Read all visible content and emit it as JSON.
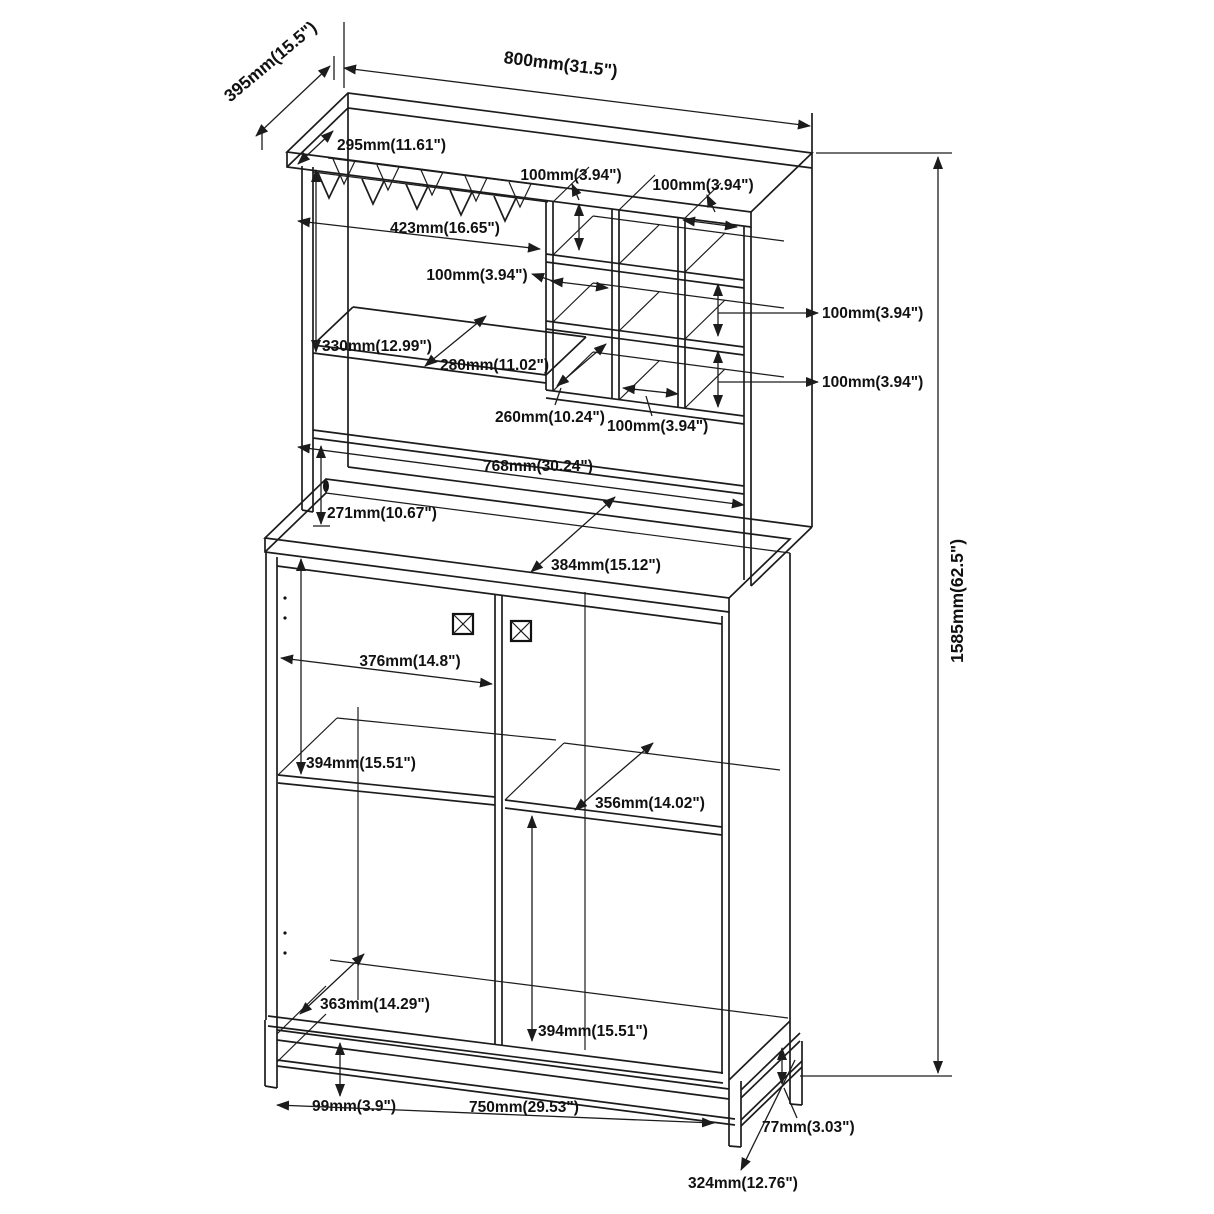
{
  "diagram": {
    "type": "furniture-dimension-drawing",
    "subject": "wine bar cabinet isometric line drawing with dimension annotations",
    "units": "mm (inches)",
    "line_color": "#1c1c1c",
    "background": "#ffffff"
  },
  "dims": {
    "top_depth": "395mm(15.5\")",
    "top_width": "800mm(31.5\")",
    "hutch_top_depth": "295mm(11.61\")",
    "cubby_col_row1": "100mm(3.94\")",
    "cubby_col_top_right": "100mm(3.94\")",
    "glass_rack_width": "423mm(16.65\")",
    "cubby_col_mid": "100mm(3.94\")",
    "left_shelf_height": "330mm(12.99\")",
    "left_shelf_depth": "280mm(11.02\")",
    "cubby_depth": "260mm(10.24\")",
    "cubby_col_bottom": "100mm(3.94\")",
    "cubby_row2_height": "100mm(3.94\")",
    "cubby_row3_height": "100mm(3.94\")",
    "hutch_inner_width": "768mm(30.24\")",
    "open_shelf_height": "271mm(10.67\")",
    "counter_depth": "384mm(15.12\")",
    "door_width": "376mm(14.8\")",
    "upper_compartment_height": "394mm(15.51\")",
    "right_shelf_depth": "356mm(14.02\")",
    "bottom_compartment_depth": "363mm(14.29\")",
    "lower_compartment_height": "394mm(15.51\")",
    "base_height": "99mm(3.9\")",
    "base_width": "750mm(29.53\")",
    "base_bar_height": "77mm(3.03\")",
    "base_side_depth": "324mm(12.76\")",
    "overall_height": "1585mm(62.5\")"
  }
}
